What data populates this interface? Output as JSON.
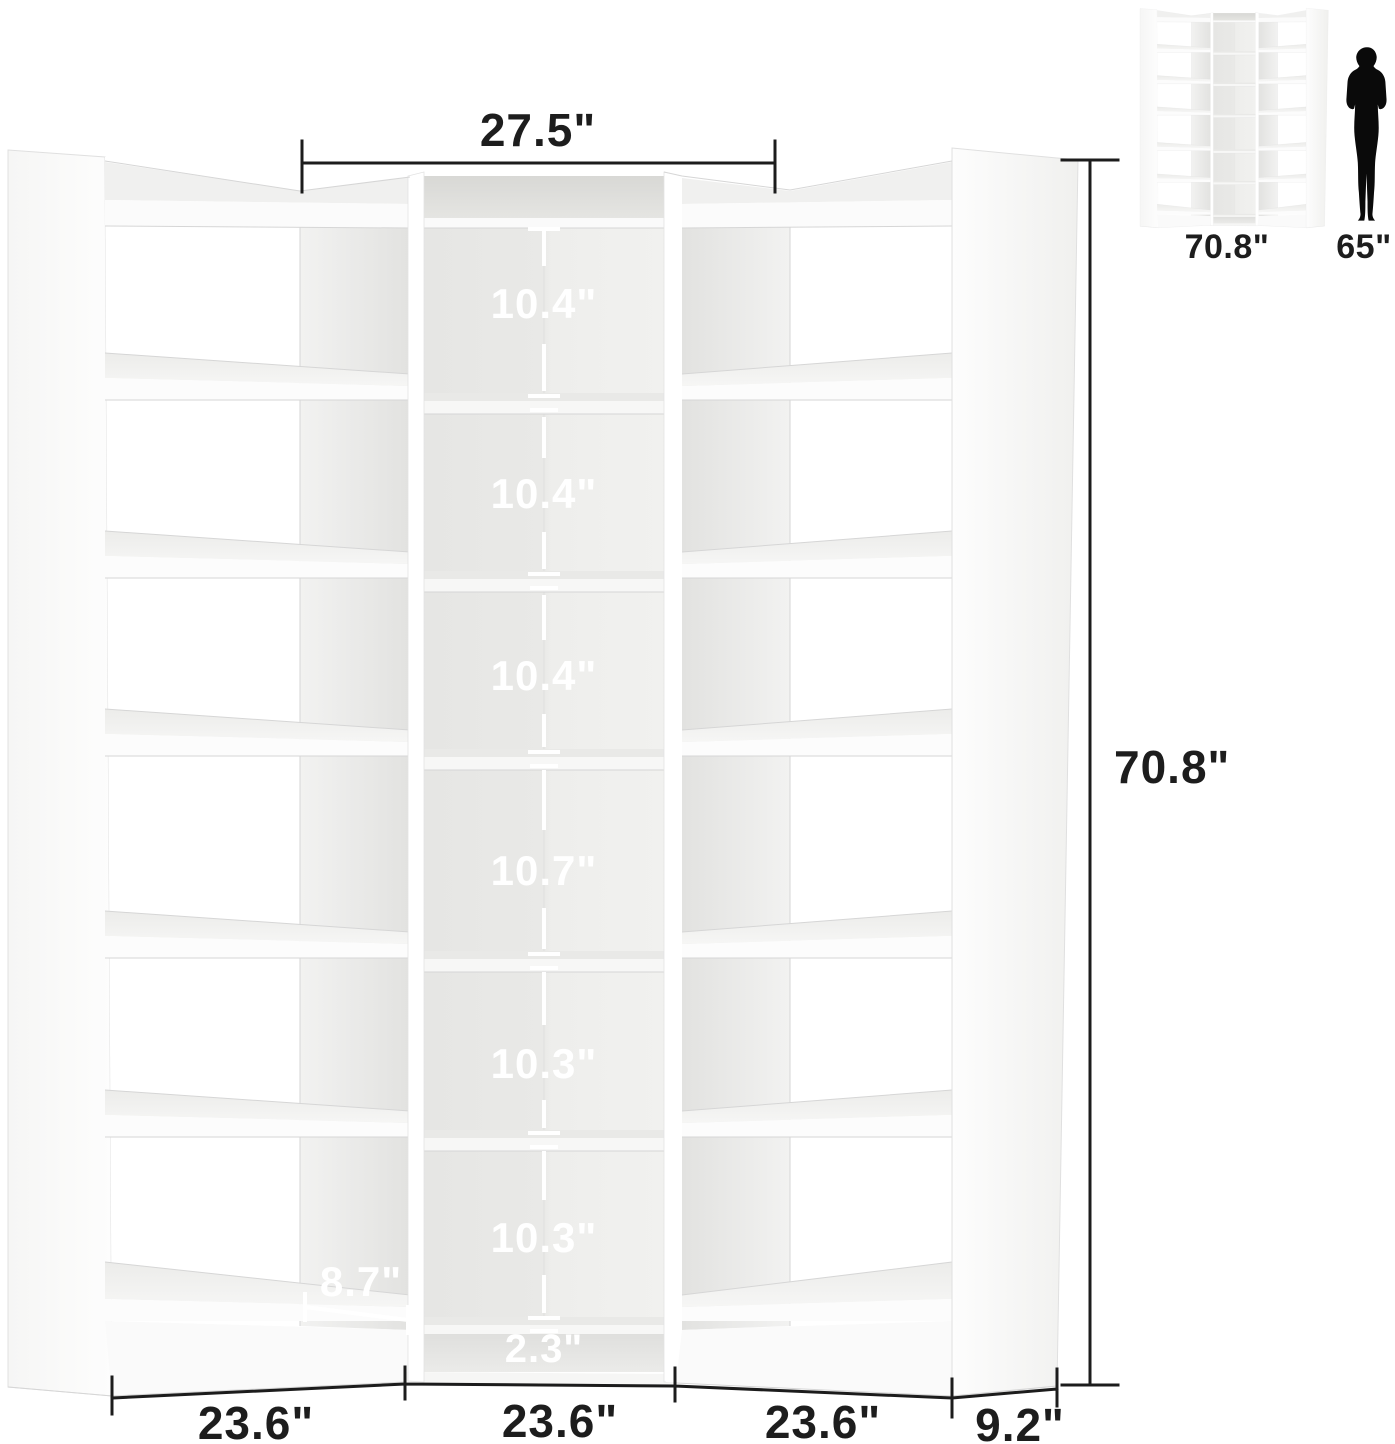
{
  "dimensions": {
    "top_width": "27.5\"",
    "total_height": "70.8\"",
    "cubby_heights": [
      "10.4\"",
      "10.4\"",
      "10.4\"",
      "10.7\"",
      "10.3\"",
      "10.3\""
    ],
    "base_height": "2.3\"",
    "side_cubby_depth": "8.7\"",
    "section_widths": [
      "23.6\"",
      "23.6\"",
      "23.6\""
    ],
    "side_depth": "9.2\""
  },
  "inset": {
    "unit_height": "70.8\"",
    "person_height": "65\""
  },
  "colors": {
    "dimension_line": "#1c1c1c",
    "dimension_text_dark": "#1d1d1d",
    "dimension_text_light": "#ffffff",
    "silhouette": "#0a0a0a",
    "background": "#ffffff"
  }
}
